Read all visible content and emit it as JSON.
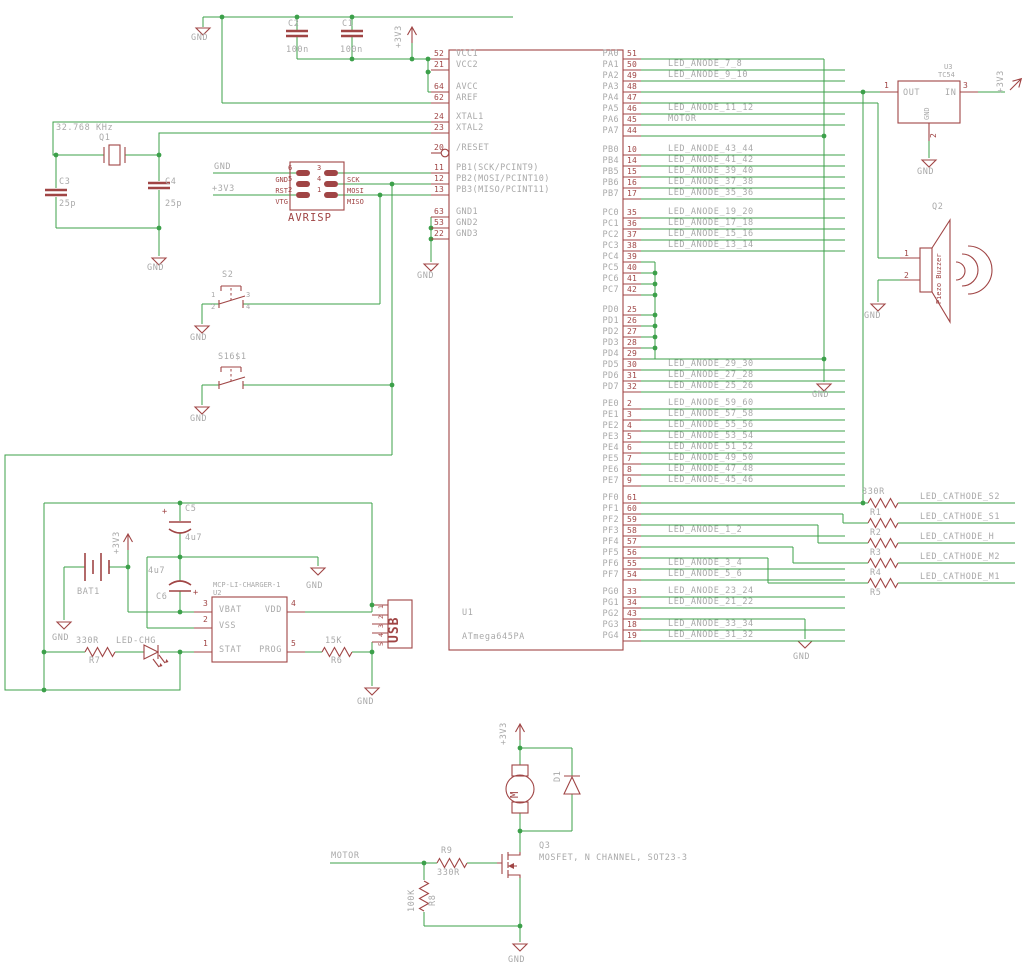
{
  "labels": {
    "gnd": "GND",
    "v33": "+3V3",
    "plus": "+"
  },
  "ic": {
    "name": "U1",
    "value": "ATmega645PA",
    "left": {
      "g0": [
        {
          "n": "52",
          "name": "VCC1"
        },
        {
          "n": "21",
          "name": "VCC2"
        }
      ],
      "g1": [
        {
          "n": "64",
          "name": "AVCC"
        },
        {
          "n": "62",
          "name": "AREF"
        }
      ],
      "g2": [
        {
          "n": "24",
          "name": "XTAL1"
        },
        {
          "n": "23",
          "name": "XTAL2"
        }
      ],
      "g3": [
        {
          "n": "20",
          "name": "/RESET"
        }
      ],
      "g4": [
        {
          "n": "11",
          "name": "PB1(SCK/PCINT9)"
        },
        {
          "n": "12",
          "name": "PB2(MOSI/PCINT10)"
        },
        {
          "n": "13",
          "name": "PB3(MISO/PCINT11)"
        }
      ],
      "g5": [
        {
          "n": "63",
          "name": "GND1"
        },
        {
          "n": "53",
          "name": "GND2"
        },
        {
          "n": "22",
          "name": "GND3"
        }
      ]
    },
    "right": {
      "pa": [
        {
          "n": "51",
          "name": "PA0",
          "label": ""
        },
        {
          "n": "50",
          "name": "PA1",
          "label": "LED_ANODE_7_8"
        },
        {
          "n": "49",
          "name": "PA2",
          "label": "LED_ANODE_9_10"
        },
        {
          "n": "48",
          "name": "PA3",
          "label": ""
        },
        {
          "n": "47",
          "name": "PA4",
          "label": ""
        },
        {
          "n": "46",
          "name": "PA5",
          "label": "LED_ANODE_11_12"
        },
        {
          "n": "45",
          "name": "PA6",
          "label": "MOTOR"
        },
        {
          "n": "44",
          "name": "PA7",
          "label": ""
        }
      ],
      "pb": [
        {
          "n": "10",
          "name": "PB0",
          "label": "LED_ANODE_43_44"
        },
        {
          "n": "14",
          "name": "PB4",
          "label": "LED_ANODE_41_42"
        },
        {
          "n": "15",
          "name": "PB5",
          "label": "LED_ANODE_39_40"
        },
        {
          "n": "16",
          "name": "PB6",
          "label": "LED_ANODE_37_38"
        },
        {
          "n": "17",
          "name": "PB7",
          "label": "LED_ANODE_35_36"
        }
      ],
      "pc": [
        {
          "n": "35",
          "name": "PC0",
          "label": "LED_ANODE_19_20"
        },
        {
          "n": "36",
          "name": "PC1",
          "label": "LED_ANODE_17_18"
        },
        {
          "n": "37",
          "name": "PC2",
          "label": "LED_ANODE_15_16"
        },
        {
          "n": "38",
          "name": "PC3",
          "label": "LED_ANODE_13_14"
        },
        {
          "n": "39",
          "name": "PC4",
          "label": ""
        },
        {
          "n": "40",
          "name": "PC5",
          "label": ""
        },
        {
          "n": "41",
          "name": "PC6",
          "label": ""
        },
        {
          "n": "42",
          "name": "PC7",
          "label": ""
        }
      ],
      "pd": [
        {
          "n": "25",
          "name": "PD0",
          "label": ""
        },
        {
          "n": "26",
          "name": "PD1",
          "label": ""
        },
        {
          "n": "27",
          "name": "PD2",
          "label": ""
        },
        {
          "n": "28",
          "name": "PD3",
          "label": ""
        },
        {
          "n": "29",
          "name": "PD4",
          "label": ""
        },
        {
          "n": "30",
          "name": "PD5",
          "label": "LED_ANODE_29_30"
        },
        {
          "n": "31",
          "name": "PD6",
          "label": "LED_ANODE_27_28"
        },
        {
          "n": "32",
          "name": "PD7",
          "label": "LED_ANODE_25_26"
        }
      ],
      "pe": [
        {
          "n": "2",
          "name": "PE0",
          "label": "LED_ANODE_59_60"
        },
        {
          "n": "3",
          "name": "PE1",
          "label": "LED_ANODE_57_58"
        },
        {
          "n": "4",
          "name": "PE2",
          "label": "LED_ANODE_55_56"
        },
        {
          "n": "5",
          "name": "PE3",
          "label": "LED_ANODE_53_54"
        },
        {
          "n": "6",
          "name": "PE4",
          "label": "LED_ANODE_51_52"
        },
        {
          "n": "7",
          "name": "PE5",
          "label": "LED_ANODE_49_50"
        },
        {
          "n": "8",
          "name": "PE6",
          "label": "LED_ANODE_47_48"
        },
        {
          "n": "9",
          "name": "PE7",
          "label": "LED_ANODE_45_46"
        }
      ],
      "pf": [
        {
          "n": "61",
          "name": "PF0",
          "label": ""
        },
        {
          "n": "60",
          "name": "PF1",
          "label": ""
        },
        {
          "n": "59",
          "name": "PF2",
          "label": ""
        },
        {
          "n": "58",
          "name": "PF3",
          "label": "LED_ANODE_1_2"
        },
        {
          "n": "57",
          "name": "PF4",
          "label": ""
        },
        {
          "n": "56",
          "name": "PF5",
          "label": ""
        },
        {
          "n": "55",
          "name": "PF6",
          "label": "LED_ANODE_3_4"
        },
        {
          "n": "54",
          "name": "PF7",
          "label": "LED_ANODE_5_6"
        }
      ],
      "pg": [
        {
          "n": "33",
          "name": "PG0",
          "label": "LED_ANODE_23_24"
        },
        {
          "n": "34",
          "name": "PG1",
          "label": "LED_ANODE_21_22"
        },
        {
          "n": "43",
          "name": "PG2",
          "label": ""
        },
        {
          "n": "18",
          "name": "PG3",
          "label": "LED_ANODE_33_34"
        },
        {
          "n": "19",
          "name": "PG4",
          "label": "LED_ANODE_31_32"
        }
      ]
    }
  },
  "caps": {
    "c1": {
      "name": "C1",
      "value": "100n"
    },
    "c2": {
      "name": "C2",
      "value": "100n"
    },
    "c3": {
      "name": "C3",
      "value": "25p"
    },
    "c4": {
      "name": "C4",
      "value": "25p"
    },
    "c5": {
      "name": "C5",
      "value": "4u7"
    },
    "c6": {
      "name": "C6",
      "value": "4u7"
    }
  },
  "crystal": {
    "name": "Q1",
    "value": "32.768 KHz"
  },
  "avrisp": {
    "name": "AVRISP",
    "pins_left": [
      "6",
      "5",
      "2"
    ],
    "pins_right": [
      "3",
      "4",
      "1"
    ],
    "sig_left": [
      "GND",
      "RST",
      "VTG"
    ],
    "sig_right": [
      "SCK",
      "MOSI",
      "MISO"
    ]
  },
  "switches": {
    "s2": {
      "name": "S2",
      "p1": "1",
      "p2": "2",
      "p3": "3",
      "p4": "4"
    },
    "s16": {
      "name": "S16$1"
    }
  },
  "u3": {
    "name": "U3",
    "value": "TC54",
    "out": "OUT",
    "in": "IN",
    "gnd": "GND",
    "p1": "1",
    "p2": "2",
    "p3": "3"
  },
  "buzzer": {
    "name": "Q2",
    "value": "Piezo Buzzer",
    "p1": "1",
    "p2": "2"
  },
  "rbank": {
    "value": "330R",
    "names": [
      "R1",
      "R2",
      "R3",
      "R4",
      "R5"
    ],
    "nets": [
      "LED_CATHODE_S2",
      "LED_CATHODE_S1",
      "LED_CATHODE_H",
      "LED_CATHODE_M2",
      "LED_CATHODE_M1"
    ]
  },
  "charger": {
    "box_name": "MCP-LI-CHARGER-1",
    "ref": "U2",
    "vbat": "VBAT",
    "vss": "VSS",
    "stat": "STAT",
    "vdd": "VDD",
    "prog": "PROG",
    "p1": "1",
    "p2": "2",
    "p3": "3",
    "p4": "4",
    "p5": "5",
    "bat": "BAT1",
    "led": "LED-CHG",
    "r7": {
      "name": "R7",
      "value": "330R"
    },
    "r6": {
      "name": "R6",
      "value": "15K"
    }
  },
  "usb": {
    "name": "USB",
    "pins": [
      "1",
      "2",
      "3",
      "4",
      "5"
    ]
  },
  "motor_drv": {
    "net": "MOTOR",
    "motor_letter": "M",
    "d1": "D1",
    "q3": "Q3",
    "q3_desc": "MOSFET, N CHANNEL, SOT23-3",
    "r9": {
      "name": "R9",
      "value": "330R"
    },
    "r8": {
      "name": "R8",
      "value": "100K"
    }
  }
}
